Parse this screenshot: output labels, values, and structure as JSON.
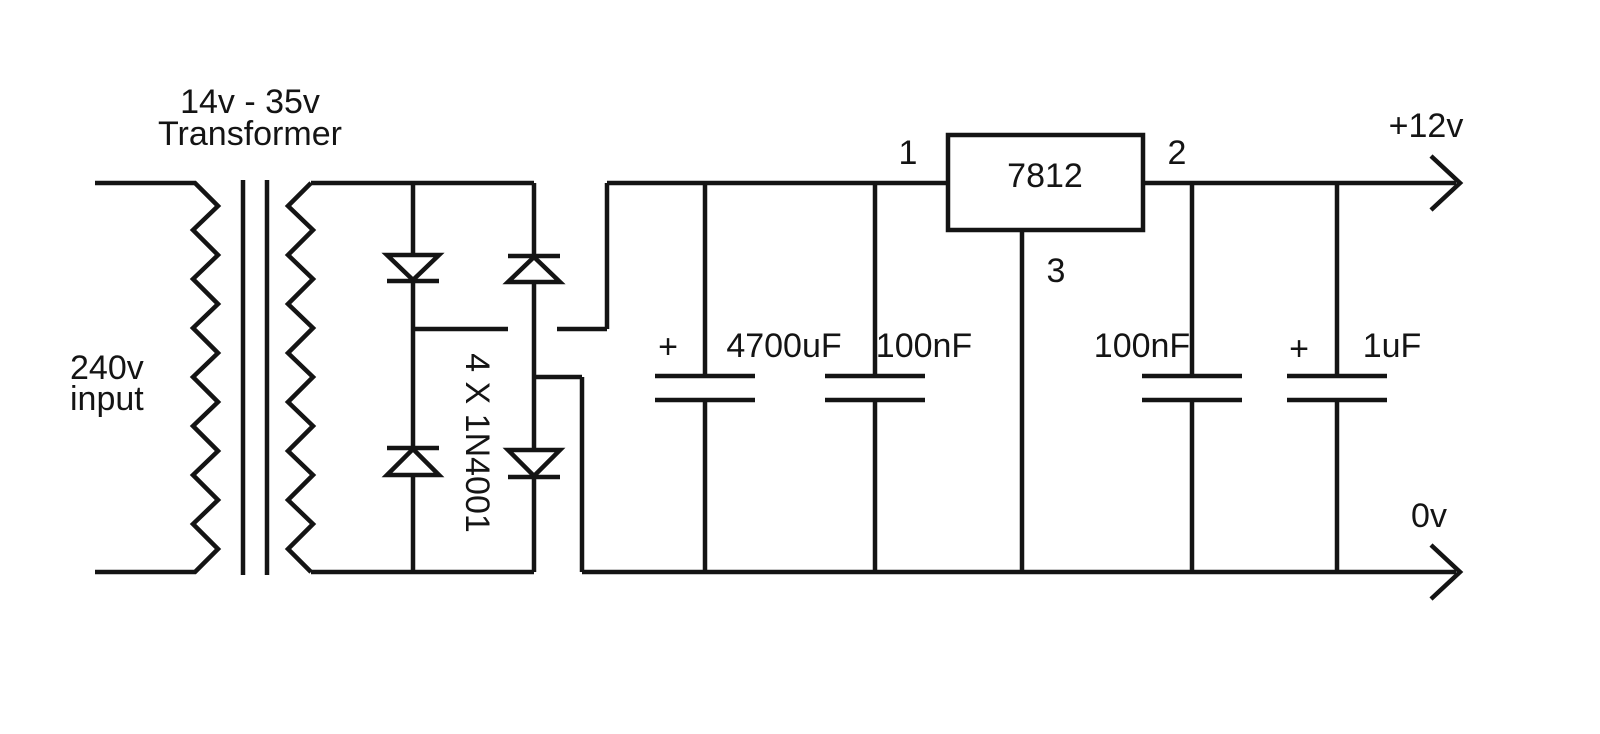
{
  "colors": {
    "line": "#141414",
    "background": "#ffffff"
  },
  "transformer": {
    "rating": "14v - 35v",
    "title": "Transformer",
    "input_line1": "240v",
    "input_line2": "input"
  },
  "rectifier": {
    "label": "4 X 1N4001"
  },
  "capacitors": {
    "smoothing_polarity": "+",
    "smoothing_value": "4700uF",
    "input_bypass_value": "100nF",
    "output_bypass_value": "100nF",
    "output_polarity": "+",
    "output_value": "1uF"
  },
  "regulator": {
    "part": "7812",
    "pin1": "1",
    "pin2": "2",
    "pin3": "3"
  },
  "outputs": {
    "positive": "+12v",
    "ground": "0v"
  }
}
